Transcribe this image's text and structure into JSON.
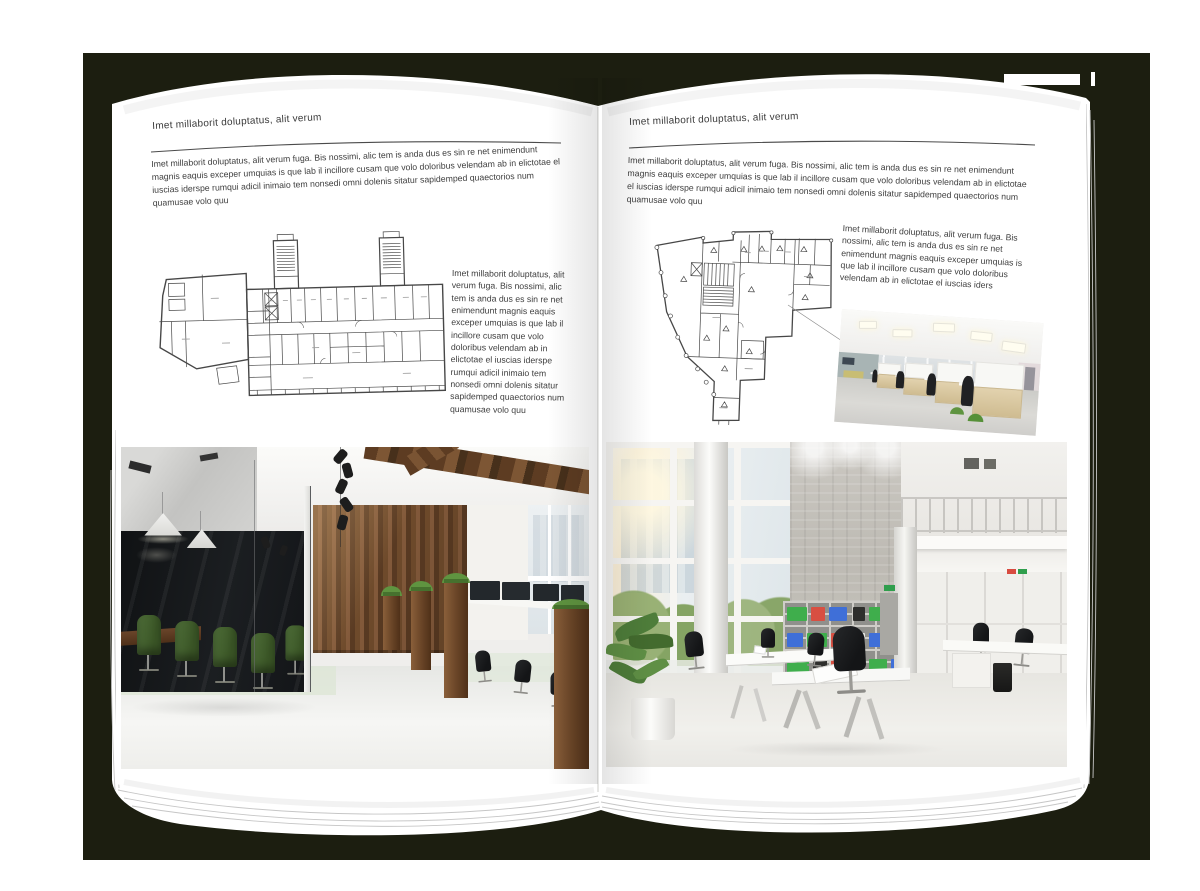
{
  "palette": {
    "backdrop": "#1c1e10",
    "page": "#ffffff",
    "text": "#3e3e3e",
    "rule": "#4b4b4b",
    "plan_lines": "#474747",
    "wood": "#6b4628",
    "chair_green": "#4c6a33",
    "binder_green": "#3fae4c",
    "binder_red": "#d84f42",
    "binder_blue": "#3f6fd8"
  },
  "left_page": {
    "header": "Imet millaborit doluptatus, alit verum",
    "intro": "Imet millaborit doluptatus, alit verum fuga. Bis nossimi, alic tem is anda dus es sin re net enimendunt magnis eaquis exceper umquias is que lab il incillore cusam que volo doloribus velendam ab in elictotae el iuscias iderspe rumqui adicil inimaio tem nonsedi omni dolenis sitatur sapidemped quaectorios num quamusae volo quu",
    "sidebar": "Imet millaborit doluptatus, alit verum fuga. Bis nossimi, alic tem is anda dus es sin re net enimendunt magnis eaquis exceper umquias is que lab il incillore cusam que volo doloribus velendam ab in elictotae el iuscias iderspe rumqui adicil inimaio tem nonsedi omni dolenis sitatur sapidemped quaectorios num quamusae volo quu",
    "floor_plan": "wide-slab-building-floor-plan",
    "photo": "loft-office-dark-glass-meeting-room-wood-wall"
  },
  "right_page": {
    "header": "Imet millaborit doluptatus, alit verum",
    "intro": "Imet millaborit doluptatus, alit verum fuga. Bis nossimi, alic tem is anda dus es sin re net enimendunt magnis eaquis exceper umquias is que lab il incillore cusam que volo doloribus velendam ab in elictotae el iuscias iderspe rumqui adicil inimaio tem nonsedi omni dolenis sitatur sapidemped quaectorios num quamusae volo quu",
    "sidebar": "Imet millaborit doluptatus, alit verum fuga. Bis nossimi, alic tem is anda dus es sin re net enimendunt magnis eaquis exceper umquias is que lab il incillore cusam que volo doloribus velendam ab in elictotae el iuscias iders",
    "floor_plan": "tower-funnel-building-floor-plan",
    "photo_small": "open-plan-cubicle-office-photo",
    "photo": "bright-atrium-office-photo"
  }
}
